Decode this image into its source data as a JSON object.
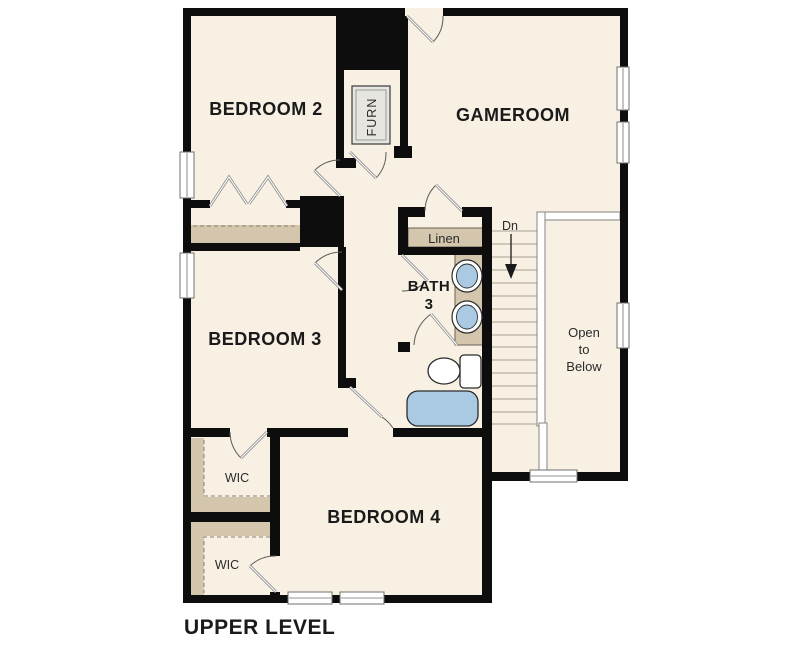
{
  "level_title": "UPPER LEVEL",
  "rooms": {
    "bedroom2": "BEDROOM 2",
    "gameroom": "GAMEROOM",
    "bedroom3": "BEDROOM 3",
    "bedroom4": "BEDROOM 4",
    "bath": {
      "name": "BATH",
      "number": "3"
    }
  },
  "closets": {
    "wic_upper": "WIC",
    "wic_lower": "WIC",
    "linen": "Linen"
  },
  "utility": {
    "furnace": "FURN"
  },
  "stairs": {
    "down_label": "Dn",
    "open_to_below": {
      "line1": "Open",
      "line2": "to",
      "line3": "Below"
    }
  },
  "colors": {
    "background": "#ffffff",
    "floor": "#f7f0e3",
    "wall": "#0d0d0d",
    "closet_shelf_tan": "#d3c6ad",
    "fixture_blue": "#aac9e3",
    "window_fill": "#ffffff",
    "label_text": "#1a1a1a"
  }
}
